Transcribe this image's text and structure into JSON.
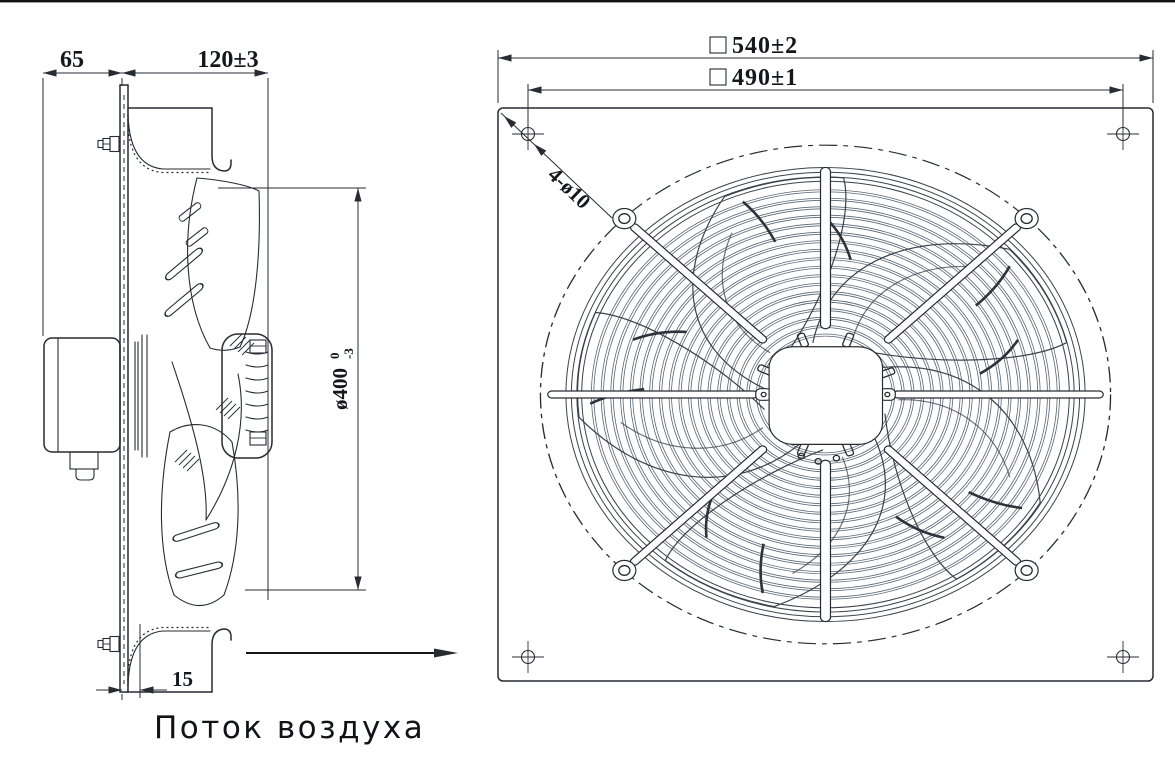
{
  "drawing": {
    "type": "axial-fan-technical-drawing",
    "line_color": "#272c33",
    "side_view": {
      "dim_flange_depth": "65",
      "dim_housing_depth": "120±3",
      "dim_impeller_diameter": "ø400",
      "dim_impeller_tol_upper": "0",
      "dim_impeller_tol_lower": "-3",
      "dim_plate_offset": "15",
      "airflow_label": "Поток воздуха"
    },
    "front_view": {
      "dim_plate_symbol": "□",
      "dim_plate": "540±2",
      "dim_hole_pitch_symbol": "□",
      "dim_hole_pitch": "490±1",
      "mount_holes_label": "4-ø10"
    }
  }
}
